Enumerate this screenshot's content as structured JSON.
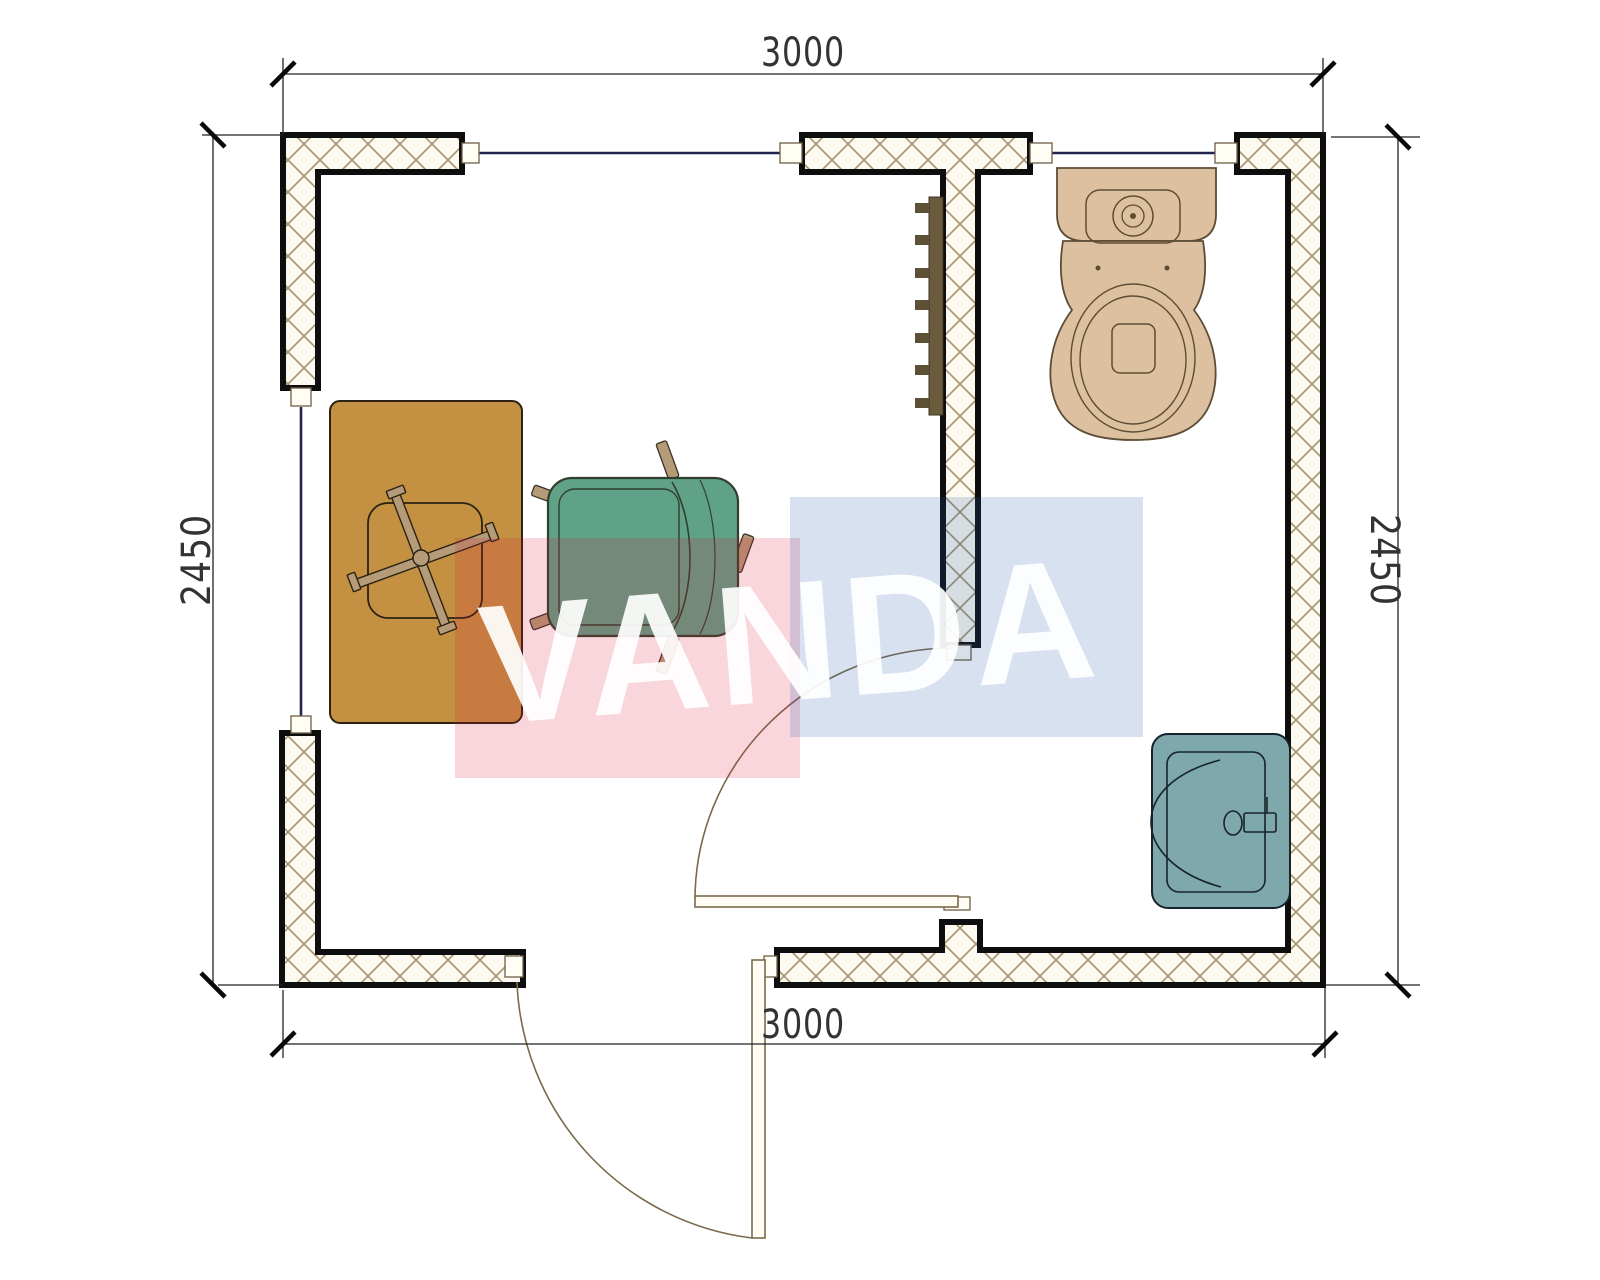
{
  "watermark": {
    "text": "VANDA",
    "pink_color": "rgba(214,30,60,0.18)",
    "blue_color": "rgba(40,90,170,0.18)",
    "text_color": "rgba(255,255,255,0.92)"
  },
  "dimensions": {
    "top": "3000",
    "bottom": "3000",
    "left": "2450",
    "right": "2450"
  },
  "colors": {
    "wall_fill": "#fcfaf0",
    "hatch_line": "#a4906a",
    "wall_stroke": "#0e0e0e",
    "window": "#23234f",
    "door": "#7a6a4a",
    "jamb_fill": "#fffdf4",
    "desk": "#c49142",
    "chair_leg": "#b59b78",
    "armchair": "#5fa287",
    "radiator": "#6a5b3d",
    "radiator_fin": "#5d5034",
    "toilet": "#dcc09f",
    "toilet_stroke": "#5d4c35",
    "sink": "#7fa8ac",
    "sink_stroke": "#16232b",
    "dim_line": "#222222",
    "dim_text": "#333333"
  },
  "furniture": [
    {
      "name": "desk"
    },
    {
      "name": "office-chair"
    },
    {
      "name": "armchair"
    },
    {
      "name": "radiator"
    },
    {
      "name": "toilet"
    },
    {
      "name": "sink"
    }
  ],
  "openings": [
    {
      "name": "window-top-left"
    },
    {
      "name": "window-top-right"
    },
    {
      "name": "window-left"
    },
    {
      "name": "door-interior"
    },
    {
      "name": "door-exterior"
    }
  ]
}
